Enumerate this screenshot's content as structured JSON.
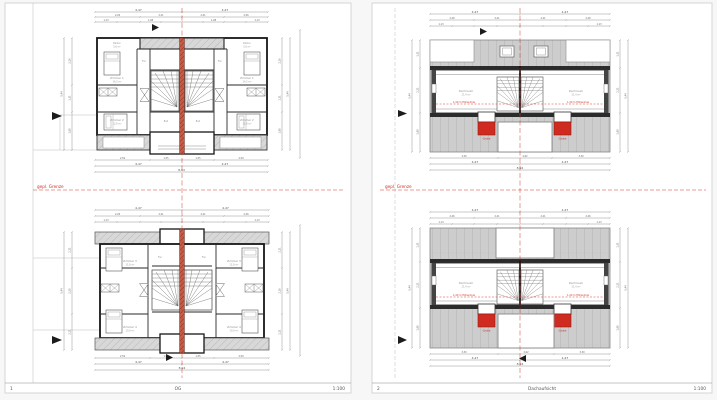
{
  "document": {
    "boundary_label": "gepl. Grenze",
    "pages": [
      {
        "number": "1",
        "title": "OG",
        "scale": "1:100"
      },
      {
        "number": "2",
        "title": "Dachaufsicht",
        "scale": "1:100"
      }
    ]
  },
  "annotations": {
    "height_line": "1,40 m Höhenlinie",
    "dormer_label": "Gaube"
  },
  "rooms": {
    "balkon": "Balkon",
    "balkon_area": "5,8 m²",
    "z1": "Zimmer 1",
    "z1a": "14,2 m²",
    "z2": "Zimmer 2",
    "z2a": "12,8 m²",
    "z3": "Zimmer 3",
    "z3a": "11,6 m²",
    "z4": "Zimmer 4",
    "z4a": "10,9 m²",
    "bad": "Bad",
    "flur": "Flur",
    "dach": "Dachraum",
    "dacha": "21,4 m²"
  },
  "dims": {
    "half": "4,47",
    "q1": "2,26",
    "q2": "2,21",
    "s1": "1,13",
    "s2": "1,08",
    "b1": "1,88",
    "b2": "2,59",
    "f1": "1,55",
    "f2": "1,31",
    "total": "8,94",
    "vt": "5,44",
    "c1": "3,30",
    "c2": "2,62"
  },
  "colors": {
    "accent_red": "#cc3326",
    "roof_gray": "#cdcdcd"
  }
}
